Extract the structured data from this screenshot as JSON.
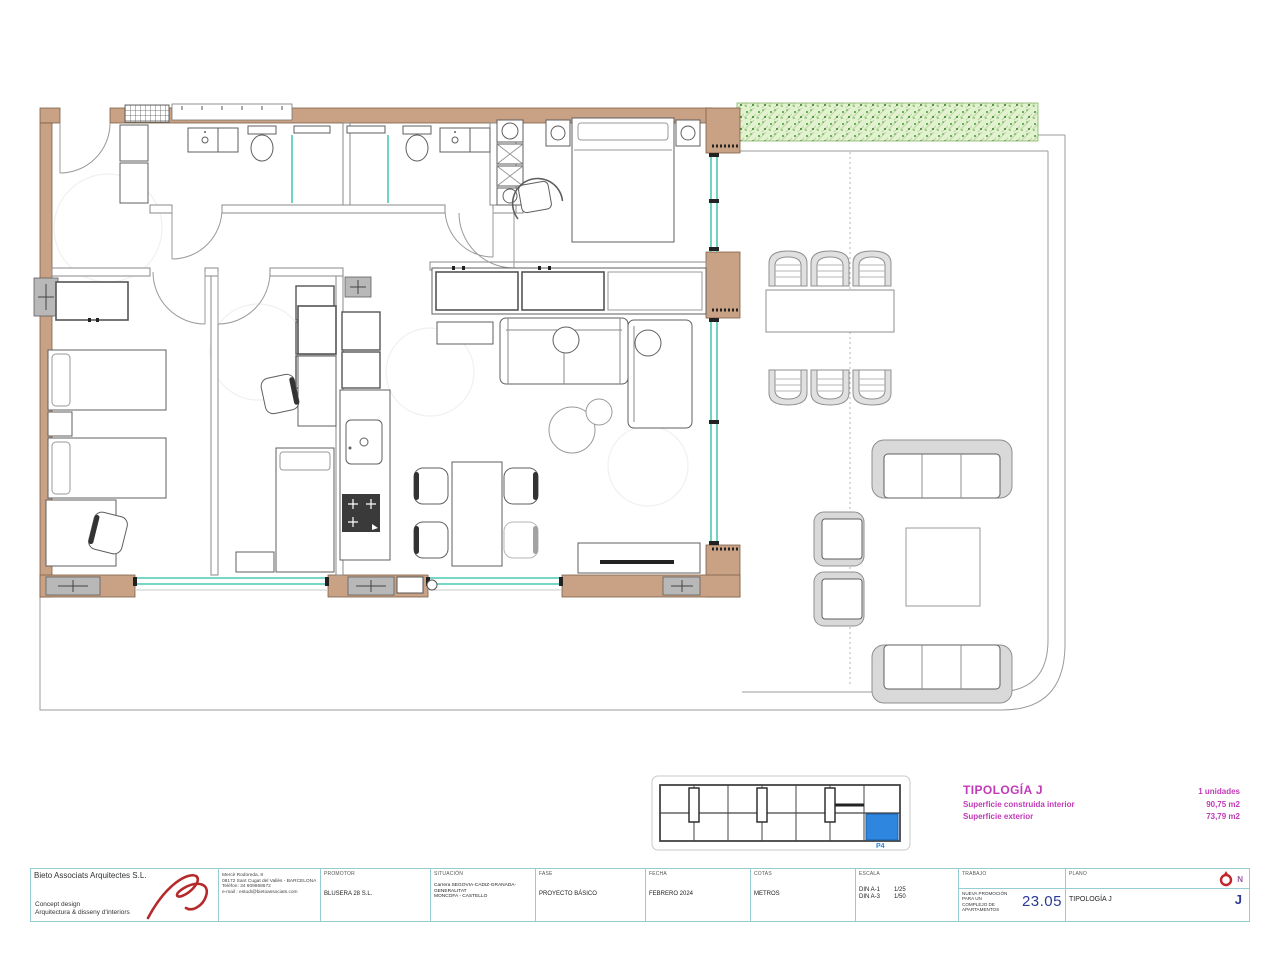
{
  "colors": {
    "wall": "#c9a184",
    "wall-edge": "#7d6148",
    "glass": "#4cc9b4",
    "magenta": "#c13ab8",
    "navy": "#2b3a92",
    "tb": "#96ccd2",
    "unit-blue": "#2e86de",
    "red-sig": "#b6292b",
    "hedge": "#e2f1cf",
    "hedge-dot": "#3f9b33"
  },
  "legend": {
    "title": "TIPOLOGÍA J",
    "units": "1 unidades",
    "rows": [
      {
        "label": "Superficie construida interior",
        "value": "90,75 m2"
      },
      {
        "label": "Superficie exterior",
        "value": "73,79 m2"
      }
    ]
  },
  "key_plan": {
    "label": "P4"
  },
  "tb": {
    "architect": {
      "name": "Bieto Associats Arquitectes S.L.",
      "tagline1": "Concept design",
      "tagline2": "Arquitectura & disseny d'interiors",
      "address": [
        "Mercè Rodoreda, 8",
        "08172 Sant Cugat del Vallès - BARCELONA",
        "Telèfon: 34 609868672",
        "e-mail : estudi@bietoassociats.com"
      ]
    },
    "fields": [
      {
        "label": "PROMOTOR",
        "lines": [
          "BLUSERA 28 S.L.",
          ""
        ]
      },
      {
        "label": "SITUACIÓN",
        "lines": [
          "Carrera SEGOVIA-CADIZ-GRANADA-GENERALITAT",
          "MONCOFA - CASTELLO"
        ]
      },
      {
        "label": "FASE",
        "lines": [
          "PROYECTO BÁSICO",
          ""
        ]
      },
      {
        "label": "FECHA",
        "lines": [
          "FEBRERO 2024",
          ""
        ]
      },
      {
        "label": "COTAS",
        "lines": [
          "METROS",
          ""
        ]
      }
    ],
    "escala": {
      "label": "ESCALA",
      "r1l": "DIN A-1",
      "r1v": "1/25",
      "r2l": "DIN A-3",
      "r2v": "1/50"
    },
    "trabajo": {
      "label": "TRABAJO",
      "line1": "NUEVA PROMOCIÓN PARA UN",
      "line2": "COMPLEJO DE APARTAMENTOS",
      "number": "23.05"
    },
    "plano": {
      "label": "PLANO",
      "value": "TIPOLOGÍA J",
      "code": "J",
      "north": "N"
    }
  }
}
